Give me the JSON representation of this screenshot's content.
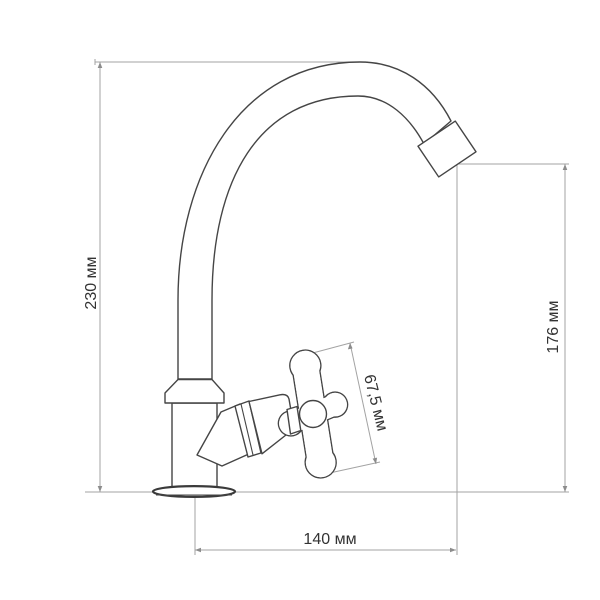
{
  "drawing": {
    "description": "Technical dimension drawing of a kitchen faucet (side view) with high curved gooseneck spout, cross handle valve and round base flange",
    "units": "мм"
  },
  "dimensions": {
    "total_height": {
      "label": "230 мм",
      "value": 230,
      "unit": "мм",
      "measures": "overall faucet height"
    },
    "spout_height": {
      "label": "176 мм",
      "value": 176,
      "unit": "мм",
      "measures": "height from base plane to spout outlet"
    },
    "handle_diameter": {
      "label": "67,5 мм",
      "value": 67.5,
      "unit": "мм",
      "measures": "cross handle diameter"
    },
    "spout_reach": {
      "label": "140 мм",
      "value": 140,
      "unit": "мм",
      "measures": "horizontal reach from base axis to spout outlet"
    }
  },
  "colors": {
    "background": "#ffffff",
    "outline": "#454545",
    "dimension_lines": "#a3a3a3",
    "label_text": "#333333"
  }
}
